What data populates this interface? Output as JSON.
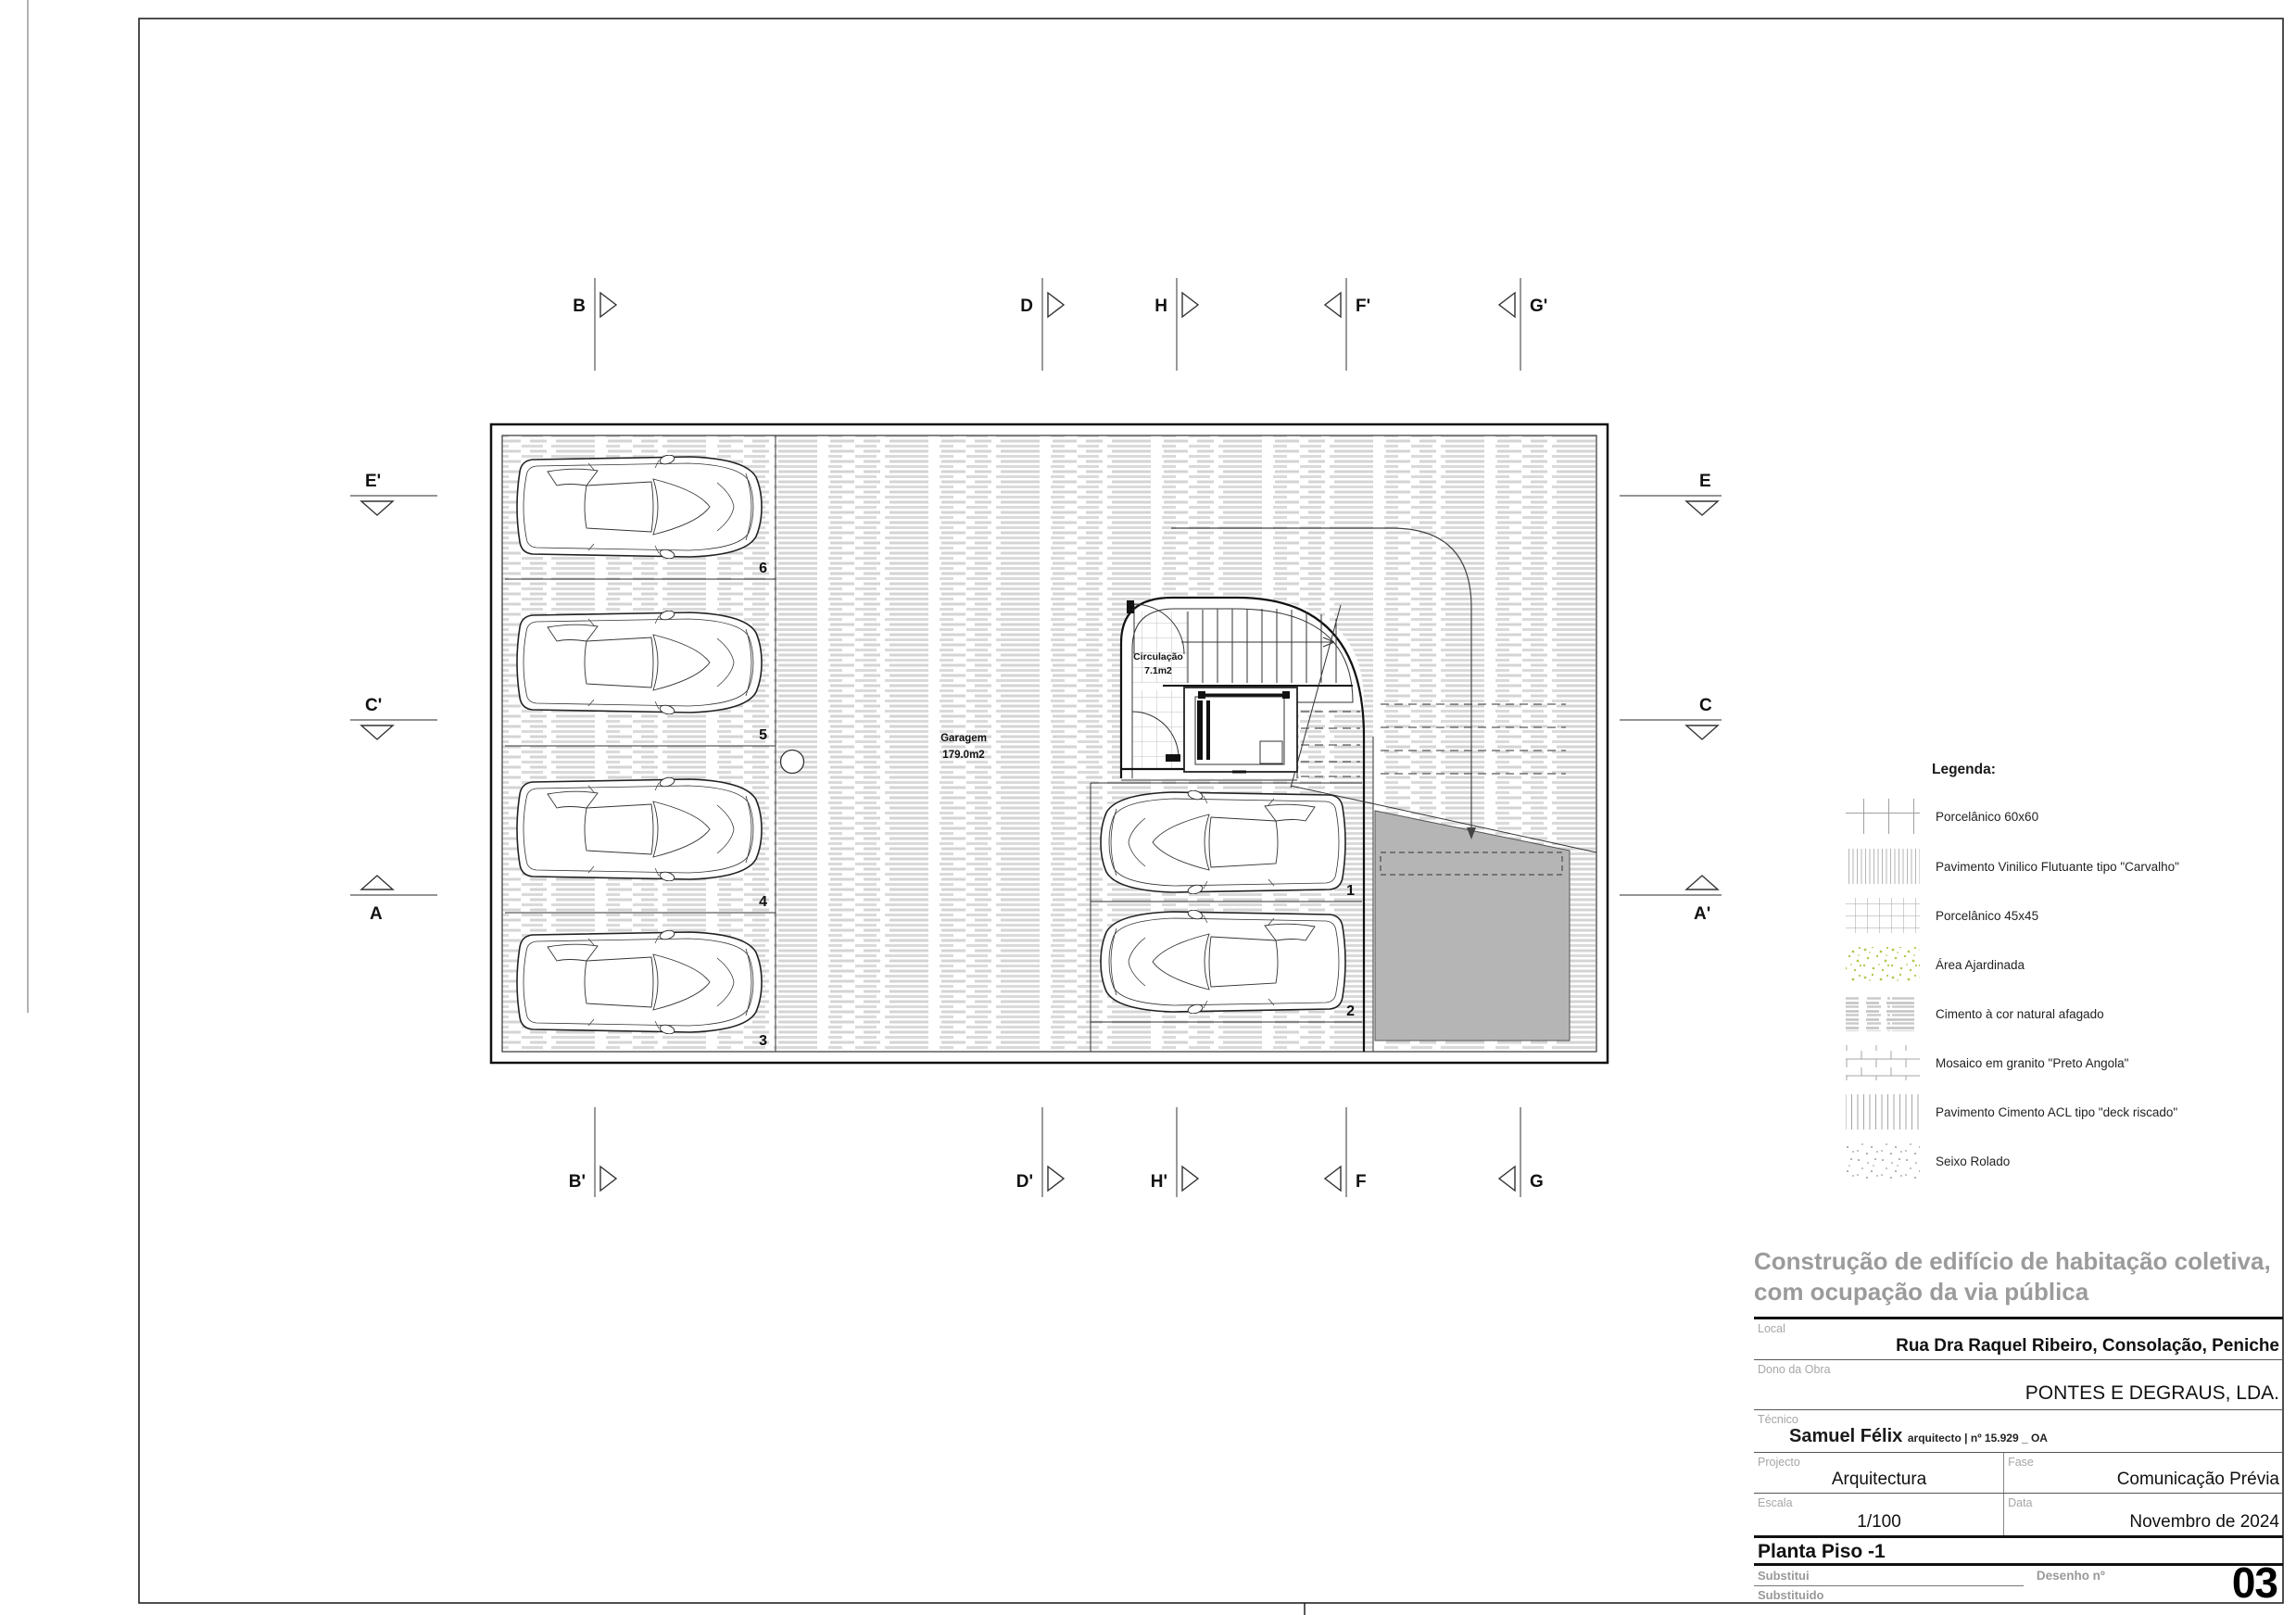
{
  "sheet": {
    "project_title_line1": "Construção de edifício de habitação coletiva,",
    "project_title_line2": "com ocupação da via pública",
    "fields": {
      "local_label": "Local",
      "local_value": "Rua Dra Raquel Ribeiro, Consolação, Peniche",
      "dono_label": "Dono da Obra",
      "dono_value": "PONTES E DEGRAUS, LDA.",
      "tecnico_label": "Técnico",
      "tecnico_name": "Samuel Félix",
      "tecnico_suffix": "arquitecto | nº 15.929 _ OA",
      "projecto_label": "Projecto",
      "projecto_value": "Arquitectura",
      "fase_label": "Fase",
      "fase_value": "Comunicação Prévia",
      "escala_label": "Escala",
      "escala_value": "1/100",
      "data_label": "Data",
      "data_value": "Novembro de 2024",
      "drawing_title": "Planta Piso -1",
      "substitui_label": "Substitui",
      "substituido_label": "Substituido",
      "desenho_label": "Desenho nº",
      "desenho_value": "03"
    }
  },
  "legend": {
    "title": "Legenda:",
    "items": [
      {
        "key": "porcelanico-60",
        "label": "Porcelânico 60x60"
      },
      {
        "key": "vinilico-carvalho",
        "label": "Pavimento Vinilico Flutuante tipo \"Carvalho\""
      },
      {
        "key": "porcelanico-45",
        "label": "Porcelânico 45x45"
      },
      {
        "key": "area-ajardinada",
        "label": "Área Ajardinada"
      },
      {
        "key": "cimento-afagado",
        "label": "Cimento à cor natural afagado"
      },
      {
        "key": "mosaico-granito",
        "label": "Mosaico em granito \"Preto Angola\""
      },
      {
        "key": "deck-riscado",
        "label": "Pavimento Cimento ACL tipo \"deck riscado\""
      },
      {
        "key": "seixo-rolado",
        "label": "Seixo Rolado"
      }
    ]
  },
  "plan": {
    "garagem_label": "Garagem",
    "garagem_area": "179.0m2",
    "circulacao_label": "Circulação",
    "circulacao_area": "7.1m2",
    "stalls": {
      "left": [
        "6",
        "5",
        "4",
        "3"
      ],
      "right": [
        "1",
        "2"
      ]
    },
    "markers": {
      "top": [
        "B",
        "D",
        "H",
        "F'",
        "G'"
      ],
      "bottom": [
        "B'",
        "D'",
        "H'",
        "F",
        "G"
      ],
      "left": [
        "E'",
        "C'",
        "A"
      ],
      "right": [
        "E",
        "C",
        "A'"
      ]
    },
    "colors": {
      "ramp_fill": "#b5b5b5",
      "hatch_gray": "#d4d4d4",
      "garden_green": "#b3c94d"
    }
  }
}
